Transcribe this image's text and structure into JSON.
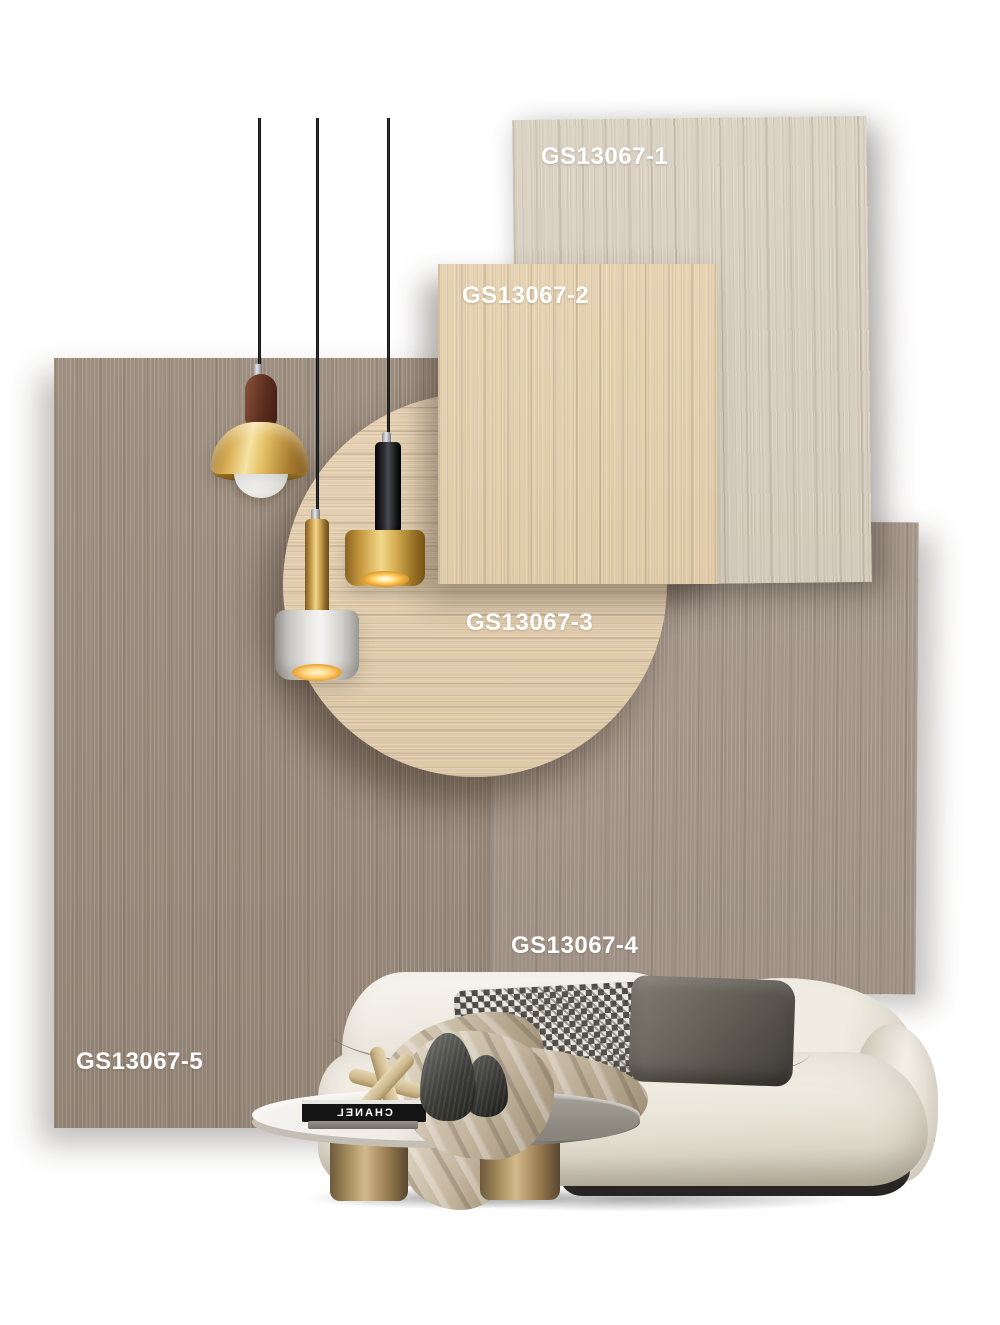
{
  "poster": {
    "background_color": "#ffffff",
    "label_color": "#ffffff",
    "swatches": [
      {
        "label": "GS13067-1",
        "shape": "rectangle",
        "grain": "vertical",
        "base_color": "#d8d0c1"
      },
      {
        "label": "GS13067-2",
        "shape": "rectangle",
        "grain": "vertical",
        "base_color": "#e4d0ad"
      },
      {
        "label": "GS13067-3",
        "shape": "circle",
        "grain": "horizontal",
        "base_color": "#e2cdad"
      },
      {
        "label": "GS13067-4",
        "shape": "rectangle",
        "grain": "vertical",
        "base_color": "#a39689"
      },
      {
        "label": "GS13067-5",
        "shape": "rectangle",
        "grain": "vertical",
        "base_color": "#9a8b7d"
      }
    ],
    "scene": {
      "pendant_lamps": [
        {
          "id": "walnut-brass-dome-pendant",
          "accent_color": "#d9af55"
        },
        {
          "id": "brass-stem-white-drum-pendant",
          "accent_color": "#f0d593"
        },
        {
          "id": "black-stem-brass-drum-pendant",
          "accent_color": "#f2d88c"
        }
      ],
      "sofa_color": "#f1ede4",
      "coffee_table": {
        "book_title": "CHANEL",
        "leg_color": "#a8905f"
      }
    }
  }
}
